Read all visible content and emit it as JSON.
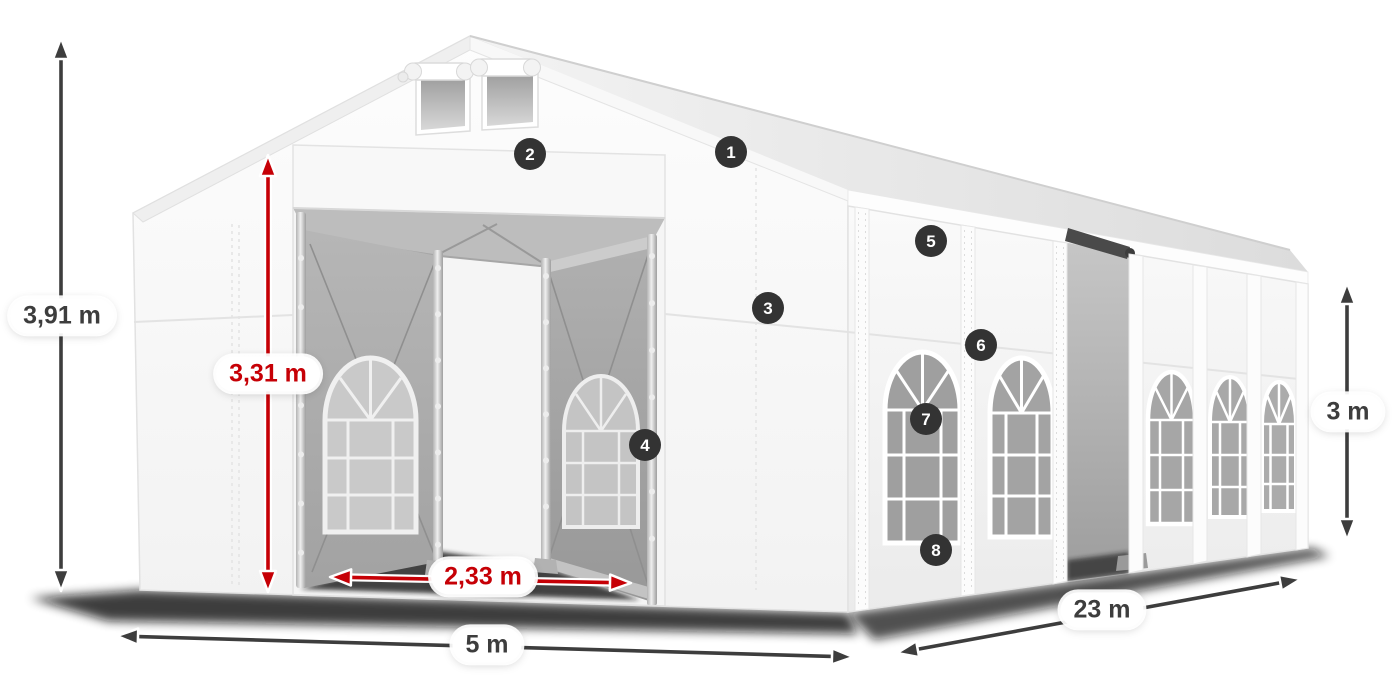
{
  "diagram_title": "Tent dimension diagram",
  "colors": {
    "dimension_dark": "#3d3d3d",
    "dimension_red": "#c60006",
    "badge_bg": "#333333",
    "badge_text": "#ffffff",
    "label_bg": "#ffffff"
  },
  "dimensions": [
    {
      "id": "total-height",
      "label": "3,91 m",
      "color_key": "dark",
      "x1": 61,
      "y1": 38,
      "x2": 61,
      "y2": 591,
      "label_x": 62,
      "label_y": 316
    },
    {
      "id": "entrance-height",
      "label": "3,31 m",
      "color_key": "red",
      "x1": 268,
      "y1": 155,
      "x2": 268,
      "y2": 592,
      "label_x": 268,
      "label_y": 374
    },
    {
      "id": "door-width",
      "label": "2,33 m",
      "color_key": "red",
      "x1": 330,
      "y1": 577,
      "x2": 631,
      "y2": 583,
      "label_x": 483,
      "label_y": 577
    },
    {
      "id": "front-width",
      "label": "5 m",
      "color_key": "dark",
      "x1": 117,
      "y1": 636,
      "x2": 853,
      "y2": 657,
      "label_x": 487,
      "label_y": 645
    },
    {
      "id": "side-length",
      "label": "23 m",
      "color_key": "dark",
      "x1": 897,
      "y1": 653,
      "x2": 1301,
      "y2": 579,
      "label_x": 1102,
      "label_y": 610
    },
    {
      "id": "side-height",
      "label": "3 m",
      "color_key": "dark",
      "x1": 1347,
      "y1": 283,
      "x2": 1347,
      "y2": 540,
      "label_x": 1348,
      "label_y": 412
    }
  ],
  "part_badges": [
    {
      "number": "1",
      "x": 731,
      "y": 152
    },
    {
      "number": "2",
      "x": 530,
      "y": 154
    },
    {
      "number": "3",
      "x": 768,
      "y": 308
    },
    {
      "number": "4",
      "x": 645,
      "y": 445
    },
    {
      "number": "5",
      "x": 931,
      "y": 241
    },
    {
      "number": "6",
      "x": 981,
      "y": 345
    },
    {
      "number": "7",
      "x": 926,
      "y": 419
    },
    {
      "number": "8",
      "x": 936,
      "y": 550
    }
  ]
}
